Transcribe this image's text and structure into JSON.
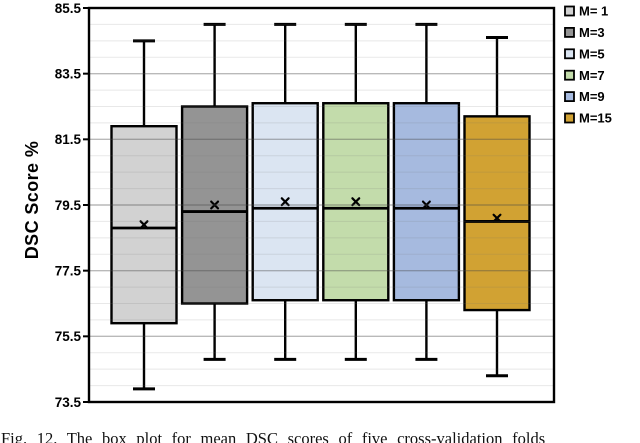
{
  "figure": {
    "caption": "Fig. 12. The box plot for mean DSC scores of five cross-validation folds"
  },
  "chart_data": {
    "type": "boxplot",
    "title": "",
    "xlabel": "",
    "ylabel": "DSC Score %",
    "ylim": [
      73.5,
      85.5
    ],
    "yticks": [
      85.5,
      83.5,
      81.5,
      79.5,
      77.5,
      75.5,
      73.5
    ],
    "minor_grid_step": 0.5,
    "grid": "horizontal",
    "legend_position": "right-outside",
    "mean_marker": "x",
    "colors": {
      "frame": "#000000",
      "grid_major": "#b0b0b0",
      "grid_minor": "#e8e8e8",
      "box_border": "#000000"
    },
    "series": [
      {
        "name": "M= 1",
        "fill": "#d2d2d2",
        "whisker_low": 73.9,
        "q1": 75.9,
        "median": 78.8,
        "mean": 78.9,
        "q3": 81.9,
        "whisker_high": 84.5
      },
      {
        "name": "M=3",
        "fill": "#949494",
        "whisker_low": 74.8,
        "q1": 76.5,
        "median": 79.3,
        "mean": 79.5,
        "q3": 82.5,
        "whisker_high": 85.0
      },
      {
        "name": "M=5",
        "fill": "#dbe5f2",
        "whisker_low": 74.8,
        "q1": 76.6,
        "median": 79.4,
        "mean": 79.6,
        "q3": 82.6,
        "whisker_high": 85.0
      },
      {
        "name": "M=7",
        "fill": "#c3dcab",
        "whisker_low": 74.8,
        "q1": 76.6,
        "median": 79.4,
        "mean": 79.6,
        "q3": 82.6,
        "whisker_high": 85.0
      },
      {
        "name": "M=9",
        "fill": "#a6badf",
        "whisker_low": 74.8,
        "q1": 76.6,
        "median": 79.4,
        "mean": 79.5,
        "q3": 82.6,
        "whisker_high": 85.0
      },
      {
        "name": "M=15",
        "fill": "#d1a233",
        "whisker_low": 74.3,
        "q1": 76.3,
        "median": 79.0,
        "mean": 79.1,
        "q3": 82.2,
        "whisker_high": 84.6
      }
    ]
  }
}
